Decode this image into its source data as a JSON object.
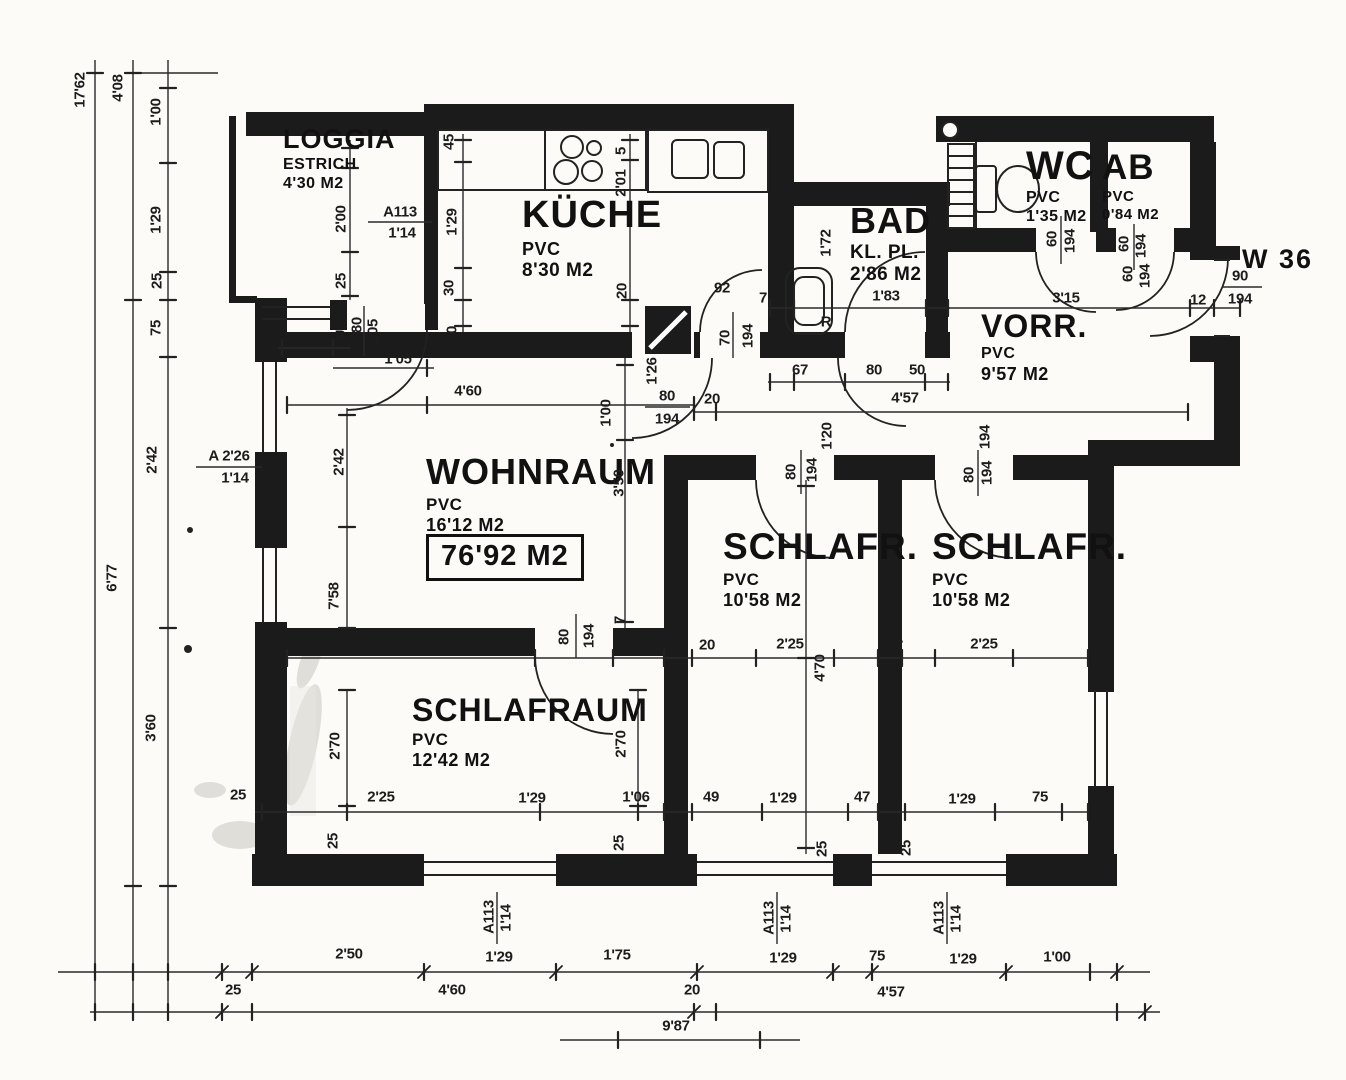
{
  "plan": {
    "unit": "W 36",
    "total": "76'92 M2",
    "radiator": "R"
  },
  "rooms": {
    "loggia": {
      "name": "LOGGIA",
      "floor": "ESTRICH",
      "area": "4'30 M2"
    },
    "kueche": {
      "name": "KÜCHE",
      "floor": "PVC",
      "area": "8'30 M2"
    },
    "bad": {
      "name": "BAD",
      "floor": "KL. PL.",
      "area": "2'86 M2"
    },
    "wc": {
      "name": "WC",
      "floor": "PVC",
      "area": "1'35 M2"
    },
    "ab": {
      "name": "AB",
      "floor": "PVC",
      "area": "0'84 M2"
    },
    "vorr": {
      "name": "VORR.",
      "floor": "PVC",
      "area": "9'57 M2"
    },
    "wohnraum": {
      "name": "WOHNRAUM",
      "floor": "PVC",
      "area": "16'12 M2"
    },
    "schlafr1": {
      "name": "SCHLAFR.",
      "floor": "PVC",
      "area": "10'58 M2"
    },
    "schlafr2": {
      "name": "SCHLAFR.",
      "floor": "PVC",
      "area": "10'58 M2"
    },
    "schlafraum": {
      "name": "SCHLAFRAUM",
      "floor": "PVC",
      "area": "12'42 M2"
    }
  },
  "doors": {
    "loggia": {
      "code": "A 80",
      "h": "205"
    },
    "kitchen": {
      "w": "70",
      "h": "194"
    },
    "wohnraum": {
      "w": "80",
      "h": "194"
    },
    "schlafraum": {
      "w": "80",
      "h": "194"
    },
    "schlafr1": {
      "w": "80",
      "h": "194"
    },
    "schlafr2": {
      "w": "80",
      "h": "194"
    },
    "wc": {
      "w": "60",
      "h": "194"
    },
    "ab": {
      "w": "60",
      "h": "194"
    },
    "ab2": {
      "w": "60",
      "h": "194"
    },
    "entry": {
      "w": "90",
      "h": "194",
      "jamb": "12"
    }
  },
  "windows": {
    "left": {
      "code": "A 2'26",
      "size": "1'14"
    },
    "loggia": {
      "code": "A113",
      "size": "1'14"
    },
    "w1": {
      "code": "A113",
      "size": "1'14"
    },
    "w2": {
      "code": "A113",
      "size": "1'14"
    },
    "w3": {
      "code": "A113",
      "size": "1'14"
    }
  },
  "dims": {
    "left_chain": [
      "17'62",
      "4'08",
      "1'00",
      "1'29",
      "25",
      "75",
      "2'42",
      "6'77",
      "3'60"
    ],
    "loggia": [
      "2'00",
      "25"
    ],
    "kitchen": [
      "45",
      "1'29",
      "30",
      "5",
      "2'01",
      "20",
      "92",
      "7"
    ],
    "bad": [
      "1'72",
      "1'83",
      "7",
      "67",
      "80",
      "50"
    ],
    "vorr": [
      "3'15",
      "4'57",
      "20"
    ],
    "wohnraum_top": [
      "50",
      "1'05",
      "4'60",
      "20"
    ],
    "wohnraum": [
      "2'42",
      "7'58",
      "1'26",
      "1'00",
      "3'50"
    ],
    "mid_row": [
      "20",
      "2'25",
      "7",
      "2'25",
      "4'60",
      "7",
      "4'70"
    ],
    "schlafraum_v": [
      "2'70",
      "2'70"
    ],
    "row_inner": [
      "25",
      "2'25",
      "1'29",
      "1'06",
      "49",
      "1'29",
      "47",
      "1'29",
      "75",
      "25",
      "25",
      "25",
      "25"
    ],
    "row_outer1": [
      "2'50",
      "1'29",
      "1'75",
      "1'29",
      "75",
      "1'29",
      "1'00"
    ],
    "row_outer2": [
      "25",
      "4'60",
      "20",
      "4'57"
    ],
    "total_width": "9'87",
    "door_extra": [
      "1'20",
      "194"
    ]
  }
}
